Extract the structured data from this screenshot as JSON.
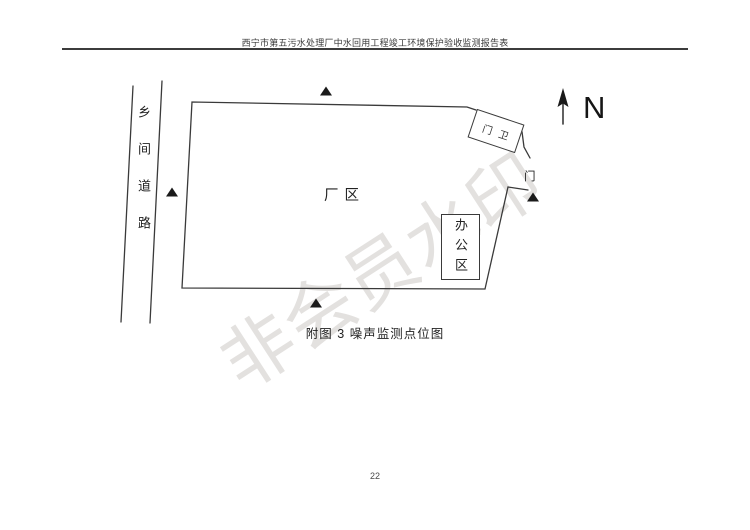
{
  "page": {
    "header_title": "西宁市第五污水处理厂中水回用工程竣工环境保护验收监测报告表",
    "page_number": "22",
    "watermark_text": "非会员水印"
  },
  "diagram": {
    "caption": "附图 3  噪声监测点位图",
    "compass_label": "N",
    "road_label": "乡间道路",
    "factory_area_label": "厂区",
    "gatehouse_label": "门卫",
    "gate_label": "门",
    "office_area_label": "办公区",
    "monitoring_marker_glyph": "▲",
    "monitoring_point_count": 4
  }
}
